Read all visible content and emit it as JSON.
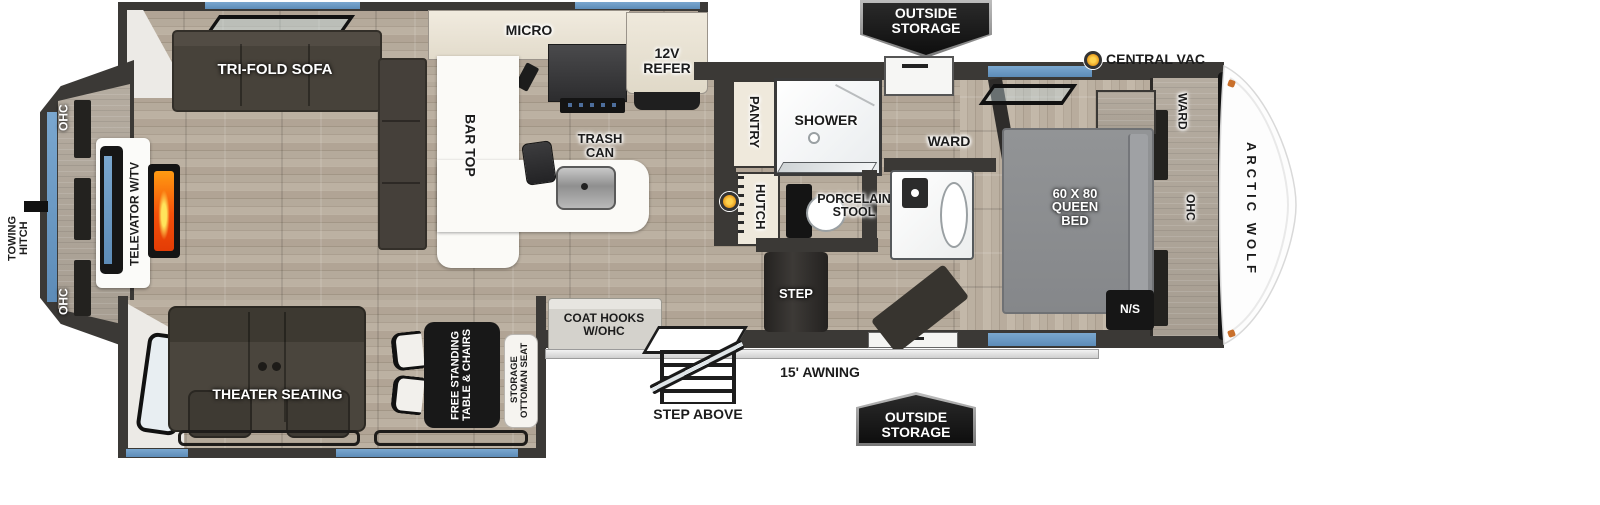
{
  "title": "Arctic Wolf fifth wheel floor plan",
  "brand": "ARCTIC WOLF",
  "colors": {
    "wall": "#3b3936",
    "floor_wood": "#b2a698",
    "accent_window_blue": "#6b9cc7",
    "badge_bg": "#141414",
    "fireplace_orange": "#ff7a00",
    "bed_gray": "#8b8d8f",
    "marker_orange": "#e8a020"
  },
  "exterior": {
    "towing_hitch": "TOWING\nHITCH",
    "outside_storage_top": "OUTSIDE\nSTORAGE",
    "outside_storage_bottom": "OUTSIDE\nSTORAGE",
    "central_vac": "CENTRAL VAC",
    "awning": "15' AWNING",
    "step_above": "STEP ABOVE"
  },
  "rear_wall": {
    "ohc_top": "OHC",
    "ohc_bottom": "OHC",
    "tv": "TELEVATOR W/TV"
  },
  "living": {
    "sofa": "TRI-FOLD SOFA",
    "theater": "THEATER SEATING",
    "table": "FREE STANDING\nTABLE & CHAIRS",
    "ottoman": "STORAGE\nOTTOMAN SEAT",
    "coat_hooks": "COAT HOOKS\nW/OHC"
  },
  "kitchen": {
    "micro": "MICRO",
    "refer": "12V\nREFER",
    "bar_top": "BAR TOP",
    "trash": "TRASH\nCAN",
    "pantry": "PANTRY",
    "hutch": "HUTCH"
  },
  "bath": {
    "shower": "SHOWER",
    "stool": "PORCELAIN\nSTOOL"
  },
  "bedroom": {
    "step": "STEP",
    "ward_mid": "WARD",
    "bed": "60 X 80\nQUEEN\nBED",
    "ward_front": "WARD",
    "ohc_front": "OHC",
    "nightstand": "N/S"
  }
}
